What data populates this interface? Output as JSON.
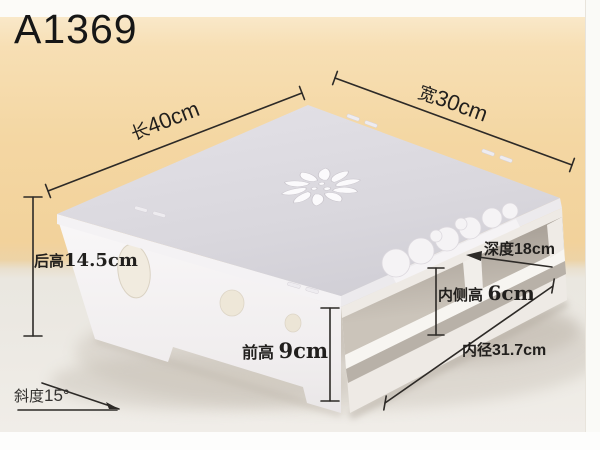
{
  "product_code": "A1369",
  "labels": {
    "length": {
      "cn": "长",
      "val": "40cm"
    },
    "width": {
      "cn": "宽",
      "val": "30cm"
    },
    "back_height": {
      "cn": "后高",
      "val": "14.5cm"
    },
    "depth": {
      "cn": "深度",
      "val": "18cm"
    },
    "inner_side_height": {
      "cn": "内侧高",
      "val": "6cm"
    },
    "inner_diameter": {
      "cn": "内径",
      "val": "31.7cm"
    },
    "front_height": {
      "cn": "前高",
      "val": "9cm"
    },
    "slope": {
      "cn": "斜度",
      "val": "15°"
    }
  },
  "colors": {
    "wall_background": "#f4d5a0",
    "floor_background": "#ECE8E2",
    "tabletop": "#d9d7dd",
    "product_white": "#f3f1f2",
    "dimension_lines": "#2d2a27",
    "text": "#1d1c1a"
  }
}
